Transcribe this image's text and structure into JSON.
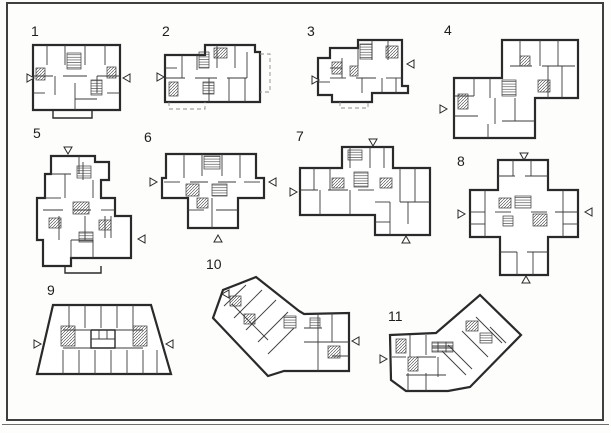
{
  "palette": {
    "paper": "#fdfdfc",
    "ink": "#3b3b3b",
    "frame": "#3f3f3f"
  },
  "plans": [
    {
      "number": "1",
      "label_pos": {
        "x": 31,
        "y": 24
      },
      "box": {
        "x": 27,
        "y": 43,
        "w": 104,
        "h": 77
      },
      "outline": "6,2 93,2 93,67 6,67",
      "solids": [
        "26,67 26,75 65,75 65,67"
      ],
      "dashed": [],
      "lines": [
        "6,33 26,33",
        "36,33 60,33",
        "70,33 93,33",
        "20,2 20,22",
        "38,2 38,22",
        "58,2 58,22",
        "78,2 78,22",
        "28,33 28,52",
        "48,40 48,67",
        "70,33 70,50",
        "6,50 18,50",
        "80,50 93,50",
        "48,56 70,56"
      ],
      "hatches": [
        [
          40,
          10,
          14,
          16,
          "h"
        ],
        [
          9,
          25,
          9,
          12,
          "d"
        ],
        [
          80,
          24,
          9,
          11,
          "d"
        ],
        [
          64,
          37,
          11,
          15,
          "h"
        ]
      ],
      "arrows": [
        {
          "dir": "right",
          "x": 0,
          "y": 31
        },
        {
          "dir": "left",
          "x": 96,
          "y": 31
        }
      ]
    },
    {
      "number": "2",
      "label_pos": {
        "x": 162,
        "y": 24
      },
      "box": {
        "x": 157,
        "y": 40,
        "w": 116,
        "h": 72
      },
      "outline": "8,15 48,15 48,5 98,5 98,12 103,12 103,62 8,62",
      "solids": [],
      "dashed": [
        "103,14 113,14 113,52 103,52",
        "12,62 12,69 48,69 48,62"
      ],
      "lines": [
        "8,38 28,38",
        "38,38 60,38",
        "70,38 90,38",
        "25,15 25,38",
        "60,5 60,28",
        "78,5 78,28",
        "90,12 90,38",
        "40,15 40,30",
        "52,38 52,62",
        "72,38 72,62",
        "88,38 88,62",
        "8,28 20,28"
      ],
      "hatches": [
        [
          42,
          12,
          10,
          16,
          "h"
        ],
        [
          57,
          8,
          13,
          10,
          "d"
        ],
        [
          12,
          42,
          9,
          14,
          "d"
        ],
        [
          46,
          42,
          11,
          12,
          "h"
        ]
      ],
      "arrows": [
        {
          "dir": "right",
          "x": 0,
          "y": 33
        }
      ]
    },
    {
      "number": "3",
      "label_pos": {
        "x": 307,
        "y": 24
      },
      "box": {
        "x": 312,
        "y": 38,
        "w": 104,
        "h": 77
      },
      "outline": "6,20 18,20 18,10 46,10 46,2 90,2 90,48 96,48 96,55 60,55 60,64 20,64 20,57 6,57",
      "solids": [],
      "dashed": [
        "28,64 28,70 56,70 56,64"
      ],
      "lines": [
        "18,40 34,40",
        "44,40 64,40",
        "74,40 90,40",
        "46,10 46,28",
        "60,2 60,22",
        "76,2 76,22",
        "30,20 30,40",
        "50,40 50,55",
        "70,40 70,55",
        "84,40 84,55",
        "18,30 30,30",
        "6,44 18,44"
      ],
      "hatches": [
        [
          48,
          6,
          12,
          15,
          "h"
        ],
        [
          20,
          24,
          10,
          12,
          "d"
        ],
        [
          74,
          8,
          12,
          12,
          "d"
        ],
        [
          38,
          28,
          8,
          10,
          "d"
        ]
      ],
      "arrows": [
        {
          "dir": "right",
          "x": 0,
          "y": 38
        },
        {
          "dir": "left",
          "x": 95,
          "y": 22
        }
      ]
    },
    {
      "number": "4",
      "label_pos": {
        "x": 444,
        "y": 23
      },
      "box": {
        "x": 440,
        "y": 36,
        "w": 146,
        "h": 106
      },
      "outline": "62,4 138,4 138,62 95,62 95,102 14,102 14,42 62,42",
      "solids": [],
      "dashed": [],
      "lines": [
        "70,30 92,30",
        "102,30 135,30",
        "80,4 80,30",
        "100,4 100,30",
        "118,4 118,30",
        "108,30 108,62",
        "122,30 122,62",
        "14,60 34,60",
        "34,42 34,60",
        "50,42 50,62",
        "14,80 38,80",
        "55,62 55,88",
        "75,62 75,85",
        "62,85 95,85",
        "48,88 48,102"
      ],
      "hatches": [
        [
          62,
          44,
          14,
          16,
          "h"
        ],
        [
          18,
          58,
          10,
          15,
          "d"
        ],
        [
          80,
          20,
          10,
          10,
          "d"
        ],
        [
          98,
          44,
          12,
          12,
          "d"
        ]
      ],
      "arrows": [
        {
          "dir": "right",
          "x": 0,
          "y": 69
        }
      ]
    },
    {
      "number": "5",
      "label_pos": {
        "x": 33,
        "y": 126
      },
      "box": {
        "x": 35,
        "y": 146,
        "w": 112,
        "h": 131
      },
      "outline": "16,10 60,10 60,16 74,16 74,34 66,34 66,52 80,52 80,70 96,70 96,112 36,112 36,120 8,120 8,94 2,94 2,52 10,52 10,28 16,28",
      "solids": [
        "30,120 30,127 66,127 66,120"
      ],
      "dashed": [],
      "lines": [
        "16,28 36,28",
        "44,10 44,28",
        "10,52 26,52",
        "30,28 30,52",
        "48,16 48,34",
        "58,34 58,52",
        "8,64 28,64",
        "38,64 56,64",
        "66,64 80,64",
        "24,70 24,94",
        "50,70 50,94",
        "70,70 70,92",
        "36,94 58,94",
        "36,94 36,112",
        "58,94 58,112",
        "76,70 76,92"
      ],
      "hatches": [
        [
          42,
          20,
          14,
          12,
          "h"
        ],
        [
          38,
          56,
          16,
          12,
          "d"
        ],
        [
          14,
          72,
          12,
          10,
          "d"
        ],
        [
          44,
          86,
          14,
          10,
          "h"
        ],
        [
          64,
          74,
          12,
          10,
          "d"
        ]
      ],
      "arrows": [
        {
          "dir": "down",
          "x": 29,
          "y": 1
        },
        {
          "dir": "left",
          "x": 103,
          "y": 89
        }
      ]
    },
    {
      "number": "6",
      "label_pos": {
        "x": 144,
        "y": 130
      },
      "box": {
        "x": 150,
        "y": 150,
        "w": 126,
        "h": 92
      },
      "outline": "16,4 106,4 106,28 114,28 114,48 88,48 88,78 38,78 38,48 12,48 12,28 16,28",
      "solids": [],
      "dashed": [],
      "lines": [
        "14,32 30,32",
        "40,32 58,32",
        "68,32 86,32",
        "94,32 110,32",
        "34,4 34,28",
        "52,4 52,26",
        "72,4 72,26",
        "90,4 90,28",
        "38,60 54,60",
        "66,60 88,60",
        "62,48 62,78"
      ],
      "hatches": [
        [
          54,
          6,
          16,
          13,
          "h"
        ],
        [
          36,
          34,
          13,
          12,
          "d"
        ],
        [
          62,
          34,
          15,
          12,
          "h"
        ],
        [
          47,
          48,
          11,
          10,
          "d"
        ]
      ],
      "arrows": [
        {
          "dir": "right",
          "x": 0,
          "y": 28
        },
        {
          "dir": "left",
          "x": 119,
          "y": 28
        },
        {
          "dir": "up",
          "x": 64,
          "y": 85
        }
      ]
    },
    {
      "number": "7",
      "label_pos": {
        "x": 296,
        "y": 129
      },
      "box": {
        "x": 290,
        "y": 138,
        "w": 146,
        "h": 106
      },
      "outline": "52,9 103,9 103,30 140,30 140,97 85,97 85,77 10,77 10,30 52,30",
      "solids": [],
      "dashed": [],
      "lines": [
        "10,52 28,52",
        "38,52 58,52",
        "68,52 84,52",
        "24,30 24,52",
        "40,30 40,52",
        "60,9 60,30",
        "80,9 80,30",
        "94,9 94,30",
        "110,30 110,64",
        "125,30 125,64",
        "85,64 100,64",
        "110,64 140,64",
        "100,64 100,97",
        "118,64 118,86",
        "85,84 100,84",
        "30,52 30,77",
        "60,52 60,77"
      ],
      "hatches": [
        [
          58,
          12,
          14,
          10,
          "h"
        ],
        [
          64,
          34,
          14,
          15,
          "h"
        ],
        [
          42,
          40,
          12,
          10,
          "d"
        ],
        [
          90,
          40,
          12,
          10,
          "d"
        ]
      ],
      "arrows": [
        {
          "dir": "down",
          "x": 79,
          "y": 1
        },
        {
          "dir": "right",
          "x": 0,
          "y": 50
        },
        {
          "dir": "up",
          "x": 112,
          "y": 98
        }
      ]
    },
    {
      "number": "8",
      "label_pos": {
        "x": 457,
        "y": 154
      },
      "box": {
        "x": 455,
        "y": 152,
        "w": 142,
        "h": 132
      },
      "outline": "43,8 93,8 93,38 123,38 123,85 93,85 93,123 45,123 45,85 15,85 15,38 43,38",
      "solids": [],
      "dashed": [],
      "lines": [
        "43,24 60,24",
        "70,24 93,24",
        "58,8 58,24",
        "76,8 76,24",
        "15,60 30,60",
        "40,60 56,60",
        "76,60 92,60",
        "100,60 123,60",
        "30,38 30,60",
        "108,38 108,60",
        "30,60 30,85",
        "108,60 108,85",
        "15,72 30,72",
        "108,72 123,72",
        "45,100 62,100",
        "72,100 93,100",
        "62,100 62,123",
        "78,100 78,123"
      ],
      "hatches": [
        [
          60,
          44,
          16,
          12,
          "h"
        ],
        [
          44,
          46,
          12,
          10,
          "d"
        ],
        [
          78,
          62,
          14,
          12,
          "d"
        ],
        [
          48,
          64,
          10,
          10,
          "h"
        ]
      ],
      "arrows": [
        {
          "dir": "down",
          "x": 65,
          "y": 1
        },
        {
          "dir": "right",
          "x": 3,
          "y": 58
        },
        {
          "dir": "left",
          "x": 130,
          "y": 56
        },
        {
          "dir": "up",
          "x": 67,
          "y": 124
        }
      ]
    },
    {
      "number": "9",
      "label_pos": {
        "x": 47,
        "y": 283
      },
      "box": {
        "x": 33,
        "y": 300,
        "w": 144,
        "h": 82
      },
      "outline": "20,5 118,5 138,74 4,74",
      "solids": [
        "58,30 82,30 82,48 58,48 58,30"
      ],
      "dashed": [],
      "lines": [
        "30,30 58,30",
        "82,30 110,30",
        "30,48 58,48",
        "82,48 110,48",
        "58,39 82,39",
        "66,30 66,39",
        "74,30 74,39",
        "36,5 36,28",
        "52,5 52,28",
        "68,5 68,28",
        "84,5 84,28",
        "100,5 100,28",
        "30,50 30,74",
        "46,50 46,74",
        "62,50 62,74",
        "78,50 78,74",
        "94,50 94,74",
        "110,50 110,74",
        "124,50 124,74"
      ],
      "hatches": [
        [
          28,
          26,
          14,
          20,
          "d"
        ],
        [
          100,
          26,
          14,
          20,
          "d"
        ]
      ],
      "arrows": [
        {
          "dir": "right",
          "x": 1,
          "y": 40
        },
        {
          "dir": "left",
          "x": 133,
          "y": 40
        }
      ]
    },
    {
      "number": "10",
      "label_pos": {
        "x": 206,
        "y": 257
      },
      "box": {
        "x": 210,
        "y": 272,
        "w": 152,
        "h": 106
      },
      "outline": "46,5 89,39 94,42 139,41 139,99 74,99 58,104 3,46 13,18",
      "solids": [],
      "dashed": [],
      "lines": [
        "14,34 36,13",
        "24,46 52,18",
        "36,58 66,28",
        "48,70 78,40",
        "58,82 84,56",
        "22,32 58,68",
        "94,56 112,56",
        "94,70 139,70",
        "108,41 108,70",
        "122,41 122,70",
        "122,84 139,84",
        "108,70 108,99"
      ],
      "hatches": [
        [
          20,
          24,
          11,
          10,
          "d"
        ],
        [
          34,
          42,
          11,
          10,
          "d"
        ],
        [
          74,
          44,
          12,
          12,
          "h"
        ],
        [
          100,
          46,
          10,
          10,
          "h"
        ],
        [
          118,
          74,
          12,
          12,
          "d"
        ]
      ],
      "arrows": [
        {
          "dir": "left",
          "x": 12,
          "y": 18
        },
        {
          "dir": "left",
          "x": 142,
          "y": 65
        }
      ]
    },
    {
      "number": "11",
      "label_pos": {
        "x": 388,
        "y": 309
      },
      "box": {
        "x": 378,
        "y": 295,
        "w": 152,
        "h": 107
      },
      "outline": "12,40 58,38 102,0 143,40 92,92 70,96 28,96 13,85",
      "solids": [],
      "dashed": [],
      "lines": [
        "32,40 32,62",
        "48,40 48,60",
        "14,62 28,62",
        "38,62 58,62",
        "30,78 30,96",
        "48,78 48,96",
        "28,80 48,80",
        "60,62 60,82",
        "48,80 68,80",
        "54,52 75,52",
        "60,47 60,57",
        "68,47 68,57",
        "70,50 94,74",
        "84,36 110,62",
        "98,22 124,48",
        "112,32 128,48",
        "64,56 88,80"
      ],
      "hatches": [
        [
          18,
          44,
          10,
          14,
          "d"
        ],
        [
          30,
          62,
          10,
          14,
          "d"
        ],
        [
          54,
          47,
          21,
          10,
          "h"
        ],
        [
          88,
          26,
          12,
          10,
          "d"
        ],
        [
          102,
          38,
          12,
          10,
          "h"
        ]
      ],
      "arrows": [
        {
          "dir": "right",
          "x": 2,
          "y": 60
        }
      ]
    }
  ]
}
